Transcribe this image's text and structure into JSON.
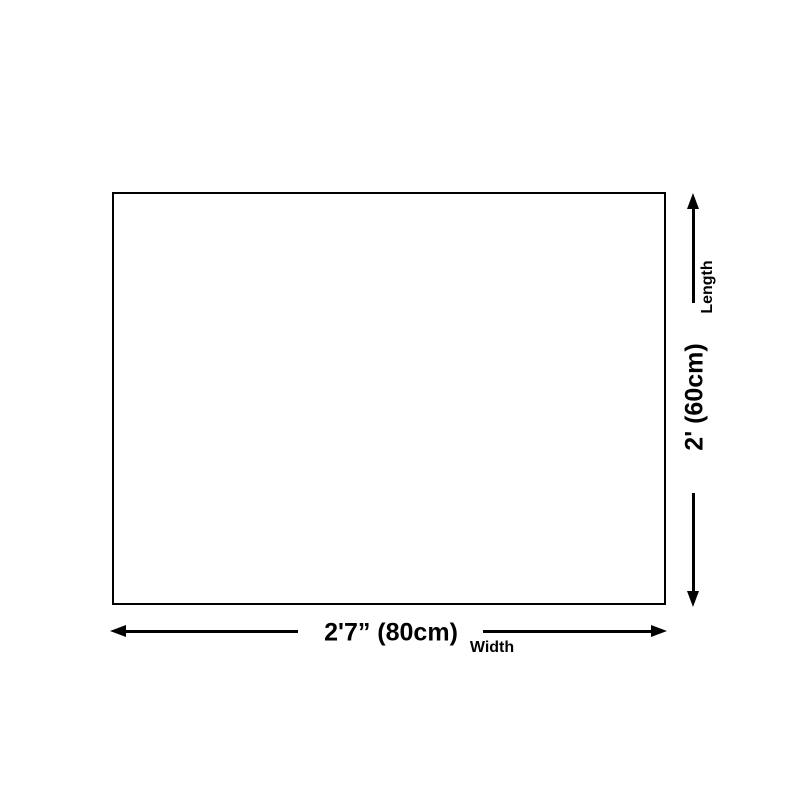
{
  "diagram": {
    "background_color": "#ffffff",
    "line_color": "#000000",
    "rectangle": {
      "fill_color": "#ffffff",
      "border_color": "#000000"
    },
    "width_dimension": {
      "value": "2'7” (80cm)",
      "label": "Width"
    },
    "length_dimension": {
      "value": "2' (60cm)",
      "label": "Length"
    }
  }
}
